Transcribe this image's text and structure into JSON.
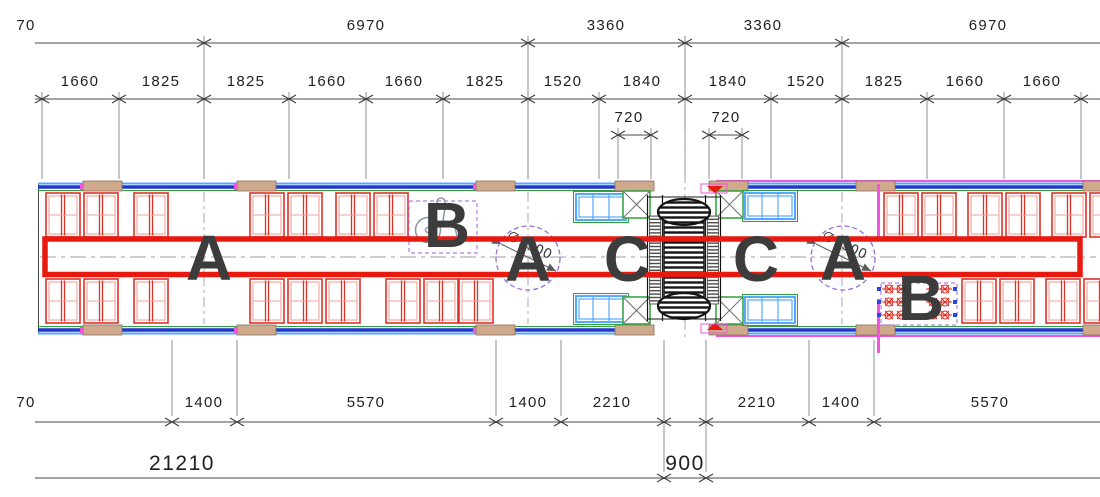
{
  "drawing": {
    "type": "rail-car floor plan, dimensioned CAD drawing",
    "top_dims_row1": [
      "70",
      "6970",
      "3360",
      "3360",
      "6970"
    ],
    "top_dims_row2": [
      "1660",
      "1825",
      "1825",
      "1660",
      "1660",
      "1825",
      "1520",
      "1840",
      "1840",
      "1520",
      "1825",
      "1660",
      "1660"
    ],
    "door_dims": [
      "720",
      "720"
    ],
    "bottom_dims_row1": [
      "70",
      "1400",
      "5570",
      "1400",
      "2210",
      "2210",
      "1400",
      "5570"
    ],
    "bottom_dims_row2": [
      "21210",
      "900"
    ],
    "turning_circles": [
      "∅1500",
      "∅1500"
    ],
    "zone_labels": [
      "A",
      "B",
      "A",
      "C",
      "C",
      "A",
      "B"
    ],
    "colors": {
      "highlight_red": "#e8190f",
      "seat_red": "#e03127",
      "wall_blue": "#2236c8",
      "light_blue": "#55a8ff",
      "magenta": "#f254e0",
      "green": "#2fa037",
      "purple": "#9a6fd8",
      "tan": "#cfa98c",
      "letter_gray": "#3c3c3c",
      "dim_line": "#4a4a4a"
    }
  }
}
